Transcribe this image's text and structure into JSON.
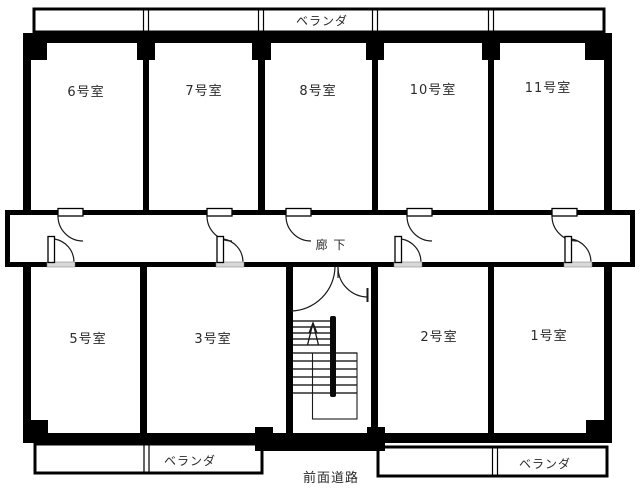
{
  "plan": {
    "title": "apartment-floor-plan",
    "verandas": {
      "top": "ベランダ",
      "bottom_left": "ベランダ",
      "bottom_right": "ベランダ"
    },
    "corridor_label": "廊 下",
    "front_road_label": "前面道路",
    "rooms_top": [
      {
        "label": "6号室"
      },
      {
        "label": "7号室"
      },
      {
        "label": "8号室"
      },
      {
        "label": "10号室"
      },
      {
        "label": "11号室"
      }
    ],
    "rooms_bottom": [
      {
        "label": "5号室"
      },
      {
        "label": "3号室"
      },
      {
        "label": "2号室"
      },
      {
        "label": "1号室"
      }
    ],
    "colors": {
      "wall": "#000000",
      "background": "#ffffff",
      "label": "#2b2b2b",
      "door_sill": "#d9d9d9"
    }
  }
}
